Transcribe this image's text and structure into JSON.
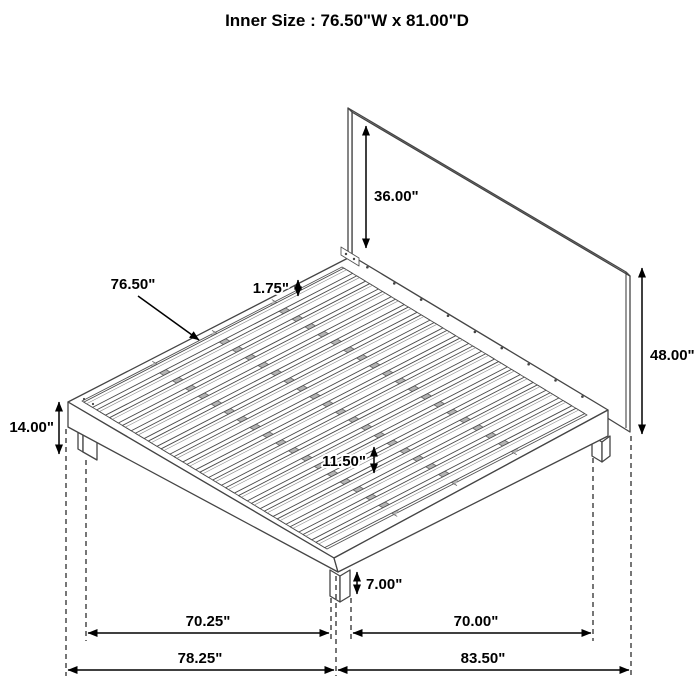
{
  "title": "Inner Size : 76.50\"W x 81.00\"D",
  "diagram": {
    "description": "platform-bed-with-headboard-dimension-diagram",
    "line_color": "#454545",
    "dimension_color": "#000000",
    "dimensions": {
      "headboard_above_platform": "36.00\"",
      "slat_length": "76.50\"",
      "slat_thickness": "1.75\"",
      "headboard_height": "48.00\"",
      "platform_height": "14.00\"",
      "slat_spacing": "11.50\"",
      "leg_height": "7.00\"",
      "left_leg_span": "70.25\"",
      "right_leg_span": "70.00\"",
      "depth_overall": "78.25\"",
      "width_overall": "83.50\""
    }
  }
}
